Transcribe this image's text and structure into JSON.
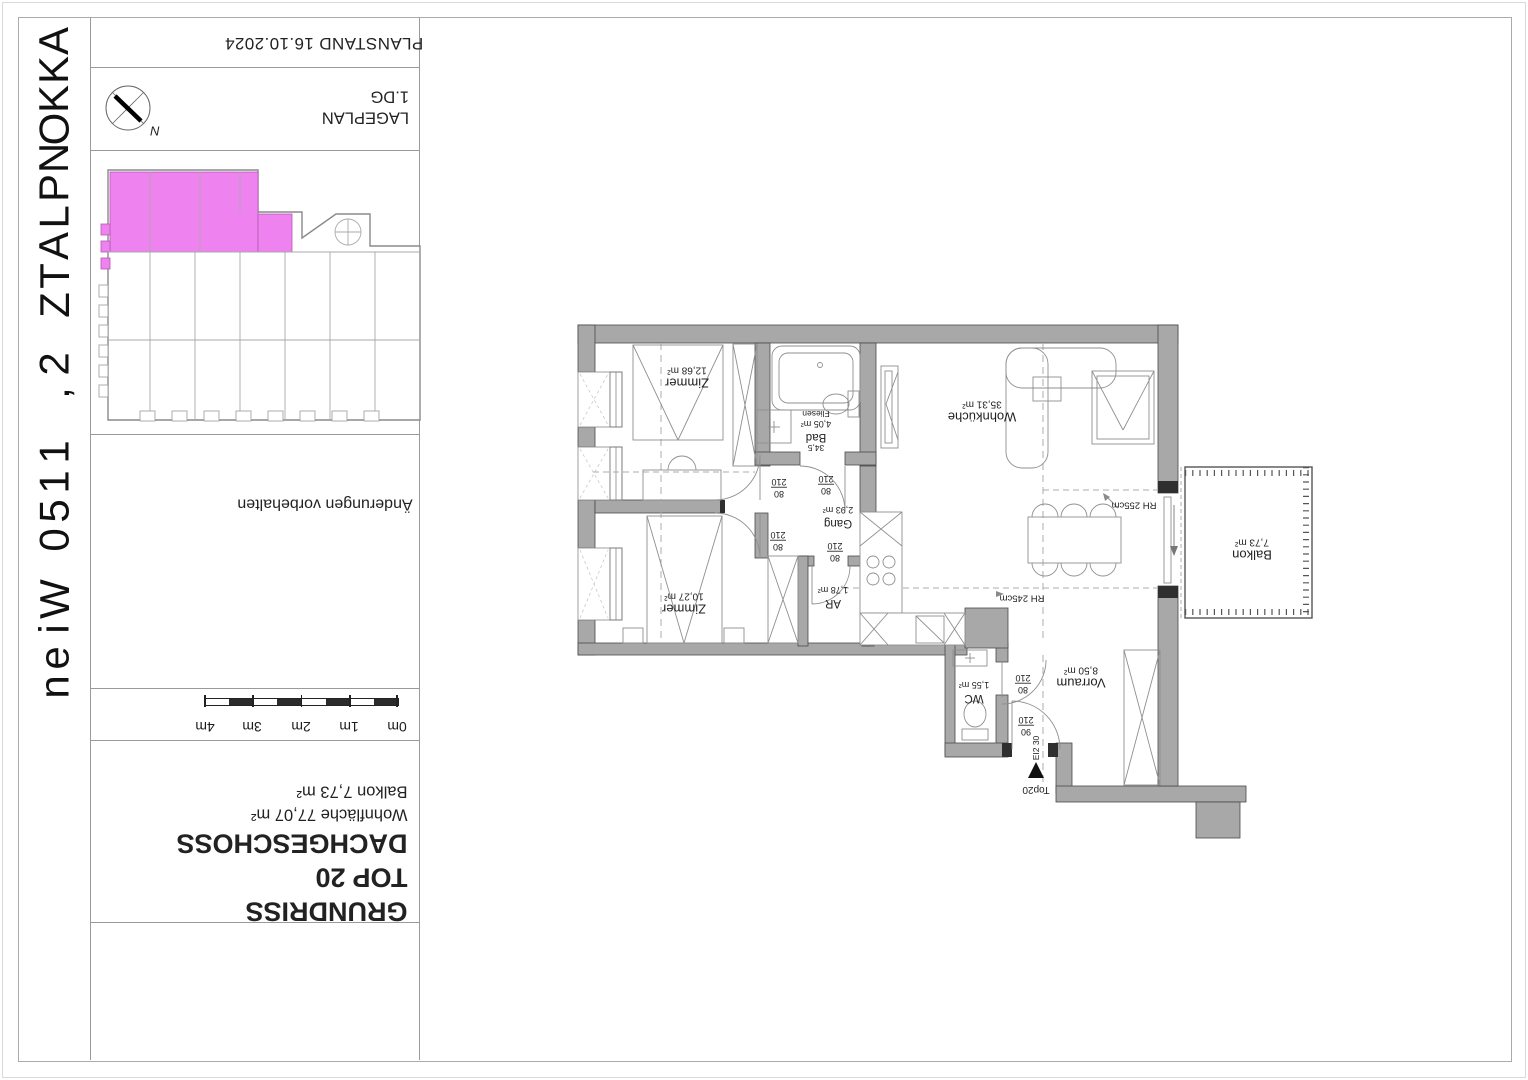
{
  "document": {
    "spine_title": "AKKONPLATZ 2, 1150 Wien",
    "planstand": "PLANSTAND 16.10.2024",
    "lageplan": {
      "title": "LAGEPLAN",
      "floor": "1.DG"
    },
    "compass_north": "N",
    "disclaimer": "Änderungen vorbehalten",
    "scalebar": {
      "labels": [
        "0m",
        "1m",
        "2m",
        "3m",
        "4m"
      ]
    },
    "titleblock": {
      "line1": "GRUNDRISS",
      "line2": "TOP 20",
      "line3": "DACHGESCHOSS",
      "area1": "Wohnfläche 77,07 m²",
      "area2": "Balkon 7,73 m²"
    }
  },
  "floorplan": {
    "rooms": {
      "zimmer1": {
        "name": "Zimmer",
        "area": "12,68 m²"
      },
      "bad": {
        "no": "34,5",
        "name": "Bad",
        "area": "4,05 m²",
        "finish": "Fliesen"
      },
      "wohnkueche": {
        "name": "Wohnküche",
        "area": "35,31 m²"
      },
      "zimmer2": {
        "name": "Zimmer",
        "area": "10,27 m²"
      },
      "gang": {
        "name": "Gang",
        "area": "2,93 m²"
      },
      "ar": {
        "name": "AR",
        "area": "1,78 m²"
      },
      "wc": {
        "name": "WC",
        "area": "1,55 m²"
      },
      "vorraum": {
        "name": "Vorraum",
        "area": "8,50 m²"
      },
      "balkon": {
        "name": "Balkon",
        "area": "7,73 m²"
      }
    },
    "doors": {
      "zimmer1": {
        "w": "80",
        "h": "210"
      },
      "bad": {
        "w": "80",
        "h": "210"
      },
      "zimmer2": {
        "w": "80",
        "h": "210"
      },
      "ar": {
        "w": "80",
        "h": "210"
      },
      "wc": {
        "w": "80",
        "h": "210"
      },
      "entry": {
        "w": "90",
        "h": "210",
        "rating": "EI2 30"
      }
    },
    "heights": {
      "h1": "RH 255cm",
      "h2": "RH 245cm"
    },
    "entry_label": "Top20"
  },
  "colors": {
    "highlight": "#ee82ee",
    "wall": "#a8a8a8"
  }
}
